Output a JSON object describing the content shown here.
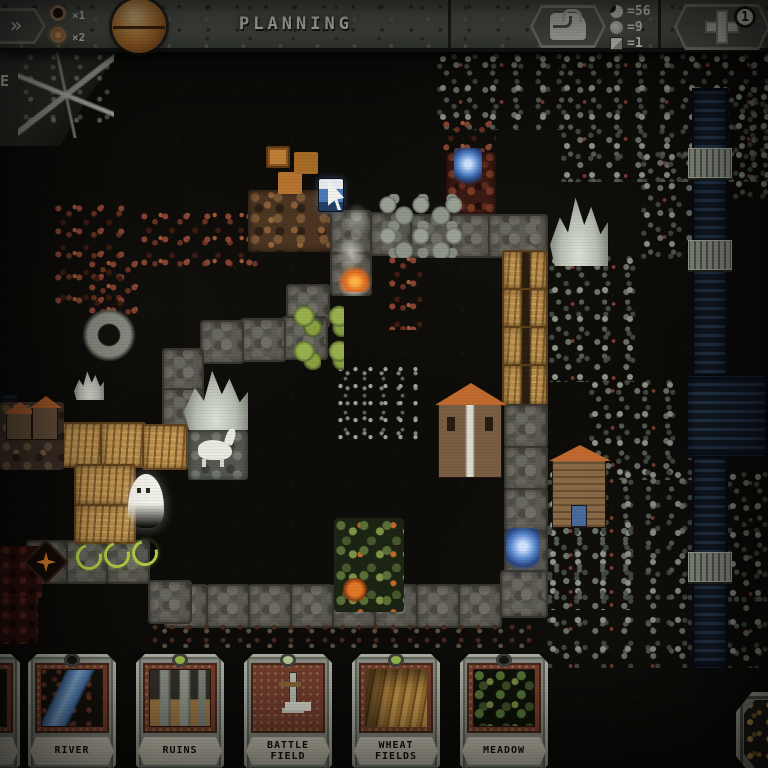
{
  "topbar": {
    "title": "PLANNING",
    "speed": {
      "fast_forward_label": "»",
      "x1_label": "×1",
      "x2_label": "×2",
      "active": "×2"
    },
    "resources": [
      {
        "icon": "moon",
        "value": "=56"
      },
      {
        "icon": "orb",
        "value": "=9"
      },
      {
        "icon": "cube",
        "value": "=1"
      }
    ],
    "supply_badge": "1"
  },
  "decor": {
    "glyph": "E"
  },
  "cards": [
    {
      "partial": true,
      "label": "",
      "art": "river",
      "gem": "#15150f"
    },
    {
      "partial": false,
      "label": "RIVER",
      "art": "river",
      "gem": "#15150f"
    },
    {
      "partial": false,
      "label": "RUINS",
      "art": "ruins",
      "gem": "#9fc24c"
    },
    {
      "partial": false,
      "label": "BATTLE\nFIELD",
      "art": "battlefield",
      "gem": "#c2d49a"
    },
    {
      "partial": false,
      "label": "WHEAT\nFIELDS",
      "art": "wheat",
      "gem": "#9fc24c"
    },
    {
      "partial": false,
      "label": "MEADOW",
      "art": "meadow",
      "gem": "#15150f"
    }
  ],
  "map": {
    "tiles": [
      {
        "t": "forest",
        "x": 436,
        "y": 52,
        "w": 130,
        "h": 78
      },
      {
        "t": "forest",
        "x": 560,
        "y": 52,
        "w": 208,
        "h": 130
      },
      {
        "t": "forest",
        "x": 640,
        "y": 150,
        "w": 60,
        "h": 110
      },
      {
        "t": "forest",
        "x": 548,
        "y": 254,
        "w": 98,
        "h": 128
      },
      {
        "t": "forest",
        "x": 588,
        "y": 378,
        "w": 108,
        "h": 102
      },
      {
        "t": "forest",
        "x": 546,
        "y": 468,
        "w": 146,
        "h": 200
      },
      {
        "t": "forest",
        "x": 726,
        "y": 470,
        "w": 42,
        "h": 198
      },
      {
        "t": "forest",
        "x": 732,
        "y": 90,
        "w": 36,
        "h": 110
      },
      {
        "t": "forest",
        "x": 546,
        "y": 518,
        "w": 100,
        "h": 92
      },
      {
        "t": "sparse",
        "x": 336,
        "y": 364,
        "w": 82,
        "h": 78
      },
      {
        "t": "thicket",
        "x": 52,
        "y": 202,
        "w": 74,
        "h": 112
      },
      {
        "t": "thicket",
        "x": 138,
        "y": 210,
        "w": 124,
        "h": 58
      },
      {
        "t": "thicket",
        "x": 86,
        "y": 258,
        "w": 52,
        "h": 62
      },
      {
        "t": "thicket",
        "x": 386,
        "y": 254,
        "w": 36,
        "h": 76
      },
      {
        "t": "thicket",
        "x": 440,
        "y": 118,
        "w": 56,
        "h": 40
      },
      {
        "t": "river",
        "x": 692,
        "y": 88,
        "w": 36,
        "h": 582
      },
      {
        "t": "river",
        "x": 686,
        "y": 374,
        "w": 82,
        "h": 84
      },
      {
        "t": "river",
        "x": 0,
        "y": 392,
        "w": 20,
        "h": 42
      },
      {
        "t": "bridge",
        "x": 688,
        "y": 148,
        "w": 44,
        "h": 30
      },
      {
        "t": "bridge",
        "x": 688,
        "y": 240,
        "w": 44,
        "h": 30
      },
      {
        "t": "bridge",
        "x": 688,
        "y": 552,
        "w": 44,
        "h": 30
      },
      {
        "t": "rock",
        "x": 248,
        "y": 190,
        "w": 84,
        "h": 62
      },
      {
        "t": "rockred",
        "x": 446,
        "y": 152,
        "w": 50,
        "h": 64
      },
      {
        "t": "path",
        "x": 330,
        "y": 210,
        "w": 42,
        "h": 46
      },
      {
        "t": "path",
        "x": 370,
        "y": 212,
        "w": 42,
        "h": 44
      },
      {
        "t": "path",
        "x": 410,
        "y": 214,
        "w": 42,
        "h": 44
      },
      {
        "t": "path",
        "x": 450,
        "y": 214,
        "w": 42,
        "h": 44
      },
      {
        "t": "path",
        "x": 488,
        "y": 214,
        "w": 60,
        "h": 44
      },
      {
        "t": "path",
        "x": 330,
        "y": 252,
        "w": 42,
        "h": 44
      },
      {
        "t": "path",
        "x": 286,
        "y": 284,
        "w": 44,
        "h": 44
      },
      {
        "t": "path",
        "x": 282,
        "y": 316,
        "w": 46,
        "h": 44
      },
      {
        "t": "path",
        "x": 240,
        "y": 318,
        "w": 46,
        "h": 44
      },
      {
        "t": "path",
        "x": 200,
        "y": 320,
        "w": 44,
        "h": 44
      },
      {
        "t": "path",
        "x": 162,
        "y": 348,
        "w": 42,
        "h": 44
      },
      {
        "t": "path",
        "x": 162,
        "y": 388,
        "w": 42,
        "h": 42
      },
      {
        "t": "boulders",
        "x": 378,
        "y": 194,
        "w": 84,
        "h": 64
      },
      {
        "t": "wheatpath",
        "x": 502,
        "y": 250,
        "w": 46,
        "h": 40
      },
      {
        "t": "wheatpath",
        "x": 502,
        "y": 288,
        "w": 46,
        "h": 40
      },
      {
        "t": "wheatpath",
        "x": 502,
        "y": 326,
        "w": 46,
        "h": 40
      },
      {
        "t": "wheatpath",
        "x": 502,
        "y": 364,
        "w": 46,
        "h": 42
      },
      {
        "t": "path",
        "x": 504,
        "y": 404,
        "w": 44,
        "h": 44
      },
      {
        "t": "path",
        "x": 504,
        "y": 446,
        "w": 44,
        "h": 44
      },
      {
        "t": "path",
        "x": 504,
        "y": 488,
        "w": 44,
        "h": 44
      },
      {
        "t": "path",
        "x": 504,
        "y": 530,
        "w": 44,
        "h": 44
      },
      {
        "t": "path",
        "x": 500,
        "y": 570,
        "w": 48,
        "h": 48
      },
      {
        "t": "path",
        "x": 458,
        "y": 584,
        "w": 44,
        "h": 44
      },
      {
        "t": "path",
        "x": 416,
        "y": 584,
        "w": 44,
        "h": 44
      },
      {
        "t": "path",
        "x": 374,
        "y": 584,
        "w": 44,
        "h": 44
      },
      {
        "t": "path",
        "x": 332,
        "y": 584,
        "w": 44,
        "h": 44
      },
      {
        "t": "path",
        "x": 290,
        "y": 584,
        "w": 44,
        "h": 44
      },
      {
        "t": "path",
        "x": 248,
        "y": 584,
        "w": 44,
        "h": 44
      },
      {
        "t": "path",
        "x": 206,
        "y": 584,
        "w": 44,
        "h": 44
      },
      {
        "t": "path",
        "x": 164,
        "y": 584,
        "w": 44,
        "h": 44
      },
      {
        "t": "path",
        "x": 148,
        "y": 580,
        "w": 44,
        "h": 44
      },
      {
        "t": "path",
        "x": 106,
        "y": 540,
        "w": 44,
        "h": 44
      },
      {
        "t": "path",
        "x": 64,
        "y": 540,
        "w": 44,
        "h": 44
      },
      {
        "t": "path",
        "x": 26,
        "y": 540,
        "w": 42,
        "h": 44
      },
      {
        "t": "wheat",
        "x": 58,
        "y": 422,
        "w": 46,
        "h": 46
      },
      {
        "t": "wheat",
        "x": 100,
        "y": 422,
        "w": 46,
        "h": 46
      },
      {
        "t": "wheat",
        "x": 142,
        "y": 424,
        "w": 46,
        "h": 46
      },
      {
        "t": "wheat",
        "x": 74,
        "y": 464,
        "w": 62,
        "h": 42
      },
      {
        "t": "wheat",
        "x": 74,
        "y": 504,
        "w": 62,
        "h": 40
      },
      {
        "t": "village",
        "x": 0,
        "y": 402,
        "w": 64,
        "h": 68
      },
      {
        "t": "villagegray",
        "x": 188,
        "y": 430,
        "w": 60,
        "h": 50
      },
      {
        "t": "mountain",
        "x": 184,
        "y": 364,
        "w": 64,
        "h": 66
      },
      {
        "t": "mountain",
        "x": 550,
        "y": 190,
        "w": 58,
        "h": 76
      },
      {
        "t": "mountain",
        "x": 74,
        "y": 368,
        "w": 30,
        "h": 32
      },
      {
        "t": "meadow",
        "x": 334,
        "y": 518,
        "w": 70,
        "h": 94
      },
      {
        "t": "bush",
        "x": 292,
        "y": 304,
        "w": 52,
        "h": 66
      },
      {
        "t": "ruinsred",
        "x": 0,
        "y": 546,
        "w": 42,
        "h": 52
      },
      {
        "t": "ruinsred",
        "x": 0,
        "y": 596,
        "w": 38,
        "h": 48
      },
      {
        "t": "fringe",
        "x": 150,
        "y": 622,
        "w": 390,
        "h": 26
      }
    ],
    "sprites": [
      {
        "t": "crates",
        "x": 266,
        "y": 146,
        "w": 24,
        "h": 22
      },
      {
        "t": "smoke",
        "x": 330,
        "y": 200,
        "w": 48,
        "h": 96
      },
      {
        "t": "fireglow",
        "x": 338,
        "y": 266,
        "w": 34,
        "h": 26
      },
      {
        "t": "hero",
        "x": 318,
        "y": 178,
        "w": 26,
        "h": 34
      },
      {
        "t": "cursor",
        "x": 328,
        "y": 180,
        "w": 22,
        "h": 30
      },
      {
        "t": "enemyblue",
        "x": 454,
        "y": 148,
        "w": 28,
        "h": 38
      },
      {
        "t": "enemyblue",
        "x": 506,
        "y": 528,
        "w": 34,
        "h": 44
      },
      {
        "t": "well",
        "x": 82,
        "y": 308,
        "w": 54,
        "h": 54
      },
      {
        "t": "horse",
        "x": 198,
        "y": 440,
        "w": 34,
        "h": 20
      },
      {
        "t": "house",
        "x": 6,
        "y": 412,
        "w": 26,
        "h": 28
      },
      {
        "t": "house",
        "x": 32,
        "y": 406,
        "w": 26,
        "h": 34
      },
      {
        "t": "church",
        "x": 438,
        "y": 402,
        "w": 64,
        "h": 76
      },
      {
        "t": "barn",
        "x": 552,
        "y": 458,
        "w": 54,
        "h": 70
      },
      {
        "t": "ghost",
        "x": 128,
        "y": 474,
        "w": 36,
        "h": 54
      },
      {
        "t": "looparrow",
        "x": 76,
        "y": 544,
        "w": 26,
        "h": 26
      },
      {
        "t": "looparrow",
        "x": 104,
        "y": 542,
        "w": 26,
        "h": 26
      },
      {
        "t": "looparrow",
        "x": 132,
        "y": 540,
        "w": 26,
        "h": 26
      },
      {
        "t": "firemark",
        "x": 30,
        "y": 546,
        "w": 32,
        "h": 32
      },
      {
        "t": "spider",
        "x": 340,
        "y": 578,
        "w": 30,
        "h": 26
      }
    ]
  }
}
